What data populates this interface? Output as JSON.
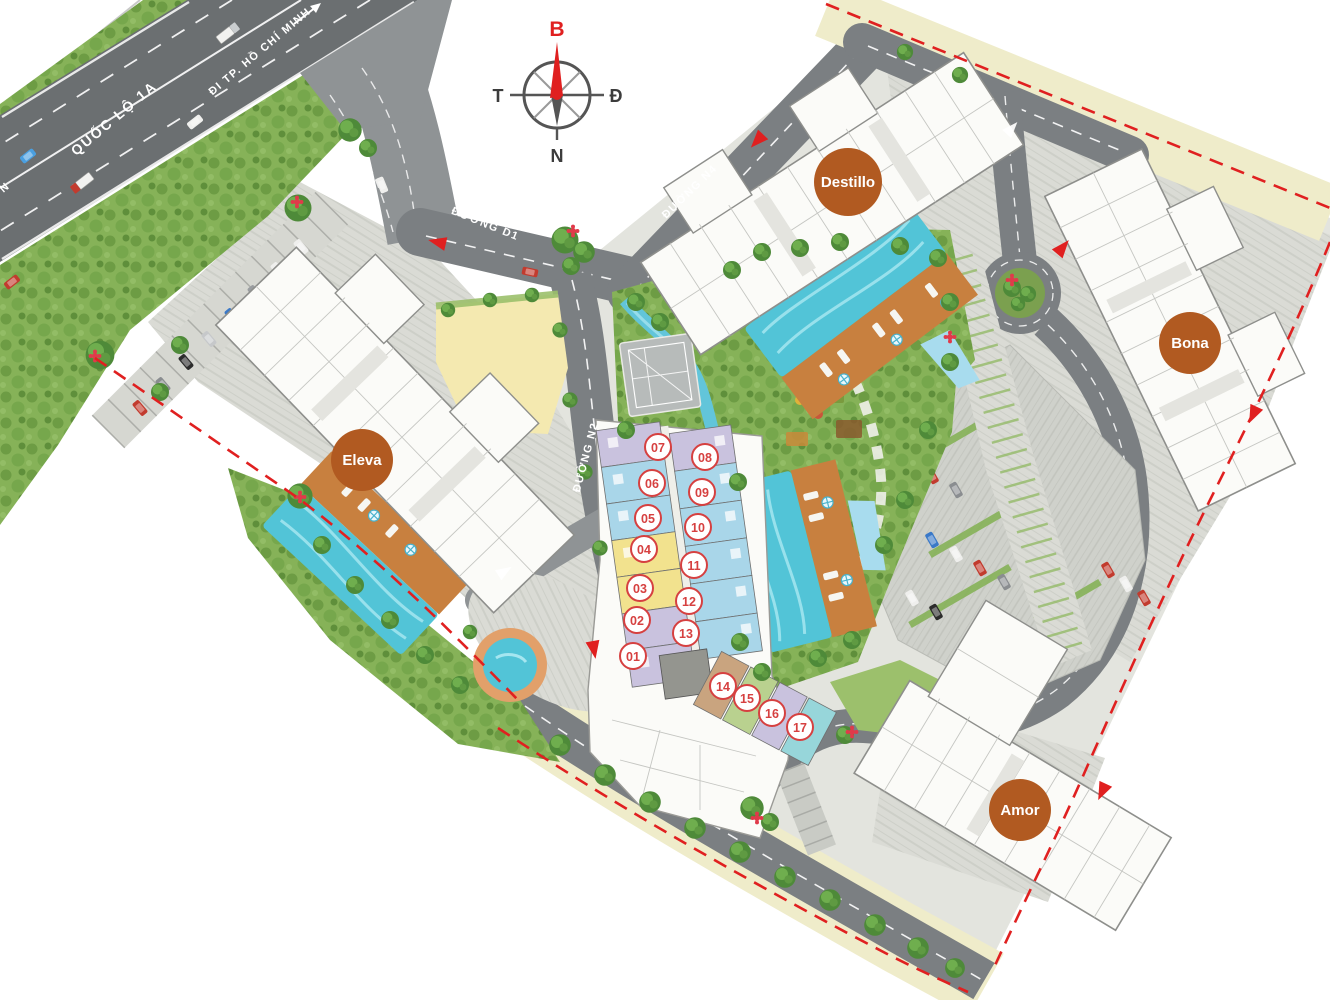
{
  "site_plan": {
    "compass": {
      "north_label": "B",
      "east_label": "Đ",
      "west_label": "T",
      "south_label": "N"
    },
    "road_labels": {
      "highway_name": "QUỐC LỘ 1A",
      "highway_direction": "ĐI TP. HỒ CHÍ MINH",
      "highway_direction_partial": "N",
      "road_d1": "ĐƯỜNG D1",
      "road_n4": "ĐƯỜNG N4",
      "road_n2": "ĐƯỜNG N2"
    },
    "towers": [
      {
        "id": "destillo",
        "name": "Destillo"
      },
      {
        "id": "bona",
        "name": "Bona"
      },
      {
        "id": "eleva",
        "name": "Eleva"
      },
      {
        "id": "amor",
        "name": "Amor"
      }
    ],
    "units": [
      {
        "label": "01"
      },
      {
        "label": "02"
      },
      {
        "label": "03"
      },
      {
        "label": "04"
      },
      {
        "label": "05"
      },
      {
        "label": "06"
      },
      {
        "label": "07"
      },
      {
        "label": "08"
      },
      {
        "label": "09"
      },
      {
        "label": "10"
      },
      {
        "label": "11"
      },
      {
        "label": "12"
      },
      {
        "label": "13"
      },
      {
        "label": "14"
      },
      {
        "label": "15"
      },
      {
        "label": "16"
      },
      {
        "label": "17"
      }
    ],
    "colors": {
      "tower_badge": "#b15a21",
      "unit_badge_border": "#d64040",
      "boundary_dash": "#e02020",
      "highway": "#6b6f71",
      "road": "#7b7f82",
      "pavement": "#dadbd5",
      "green": "#8ab25c",
      "water": "#52c4d7",
      "deck": "#c8803f",
      "cream_strip": "#efecca",
      "unit_lavender": "#c9c2de",
      "unit_blue": "#a9d6e9",
      "unit_yellow": "#f2e28e",
      "unit_brown": "#c9a47f",
      "unit_green": "#b9d18f",
      "unit_teal": "#97d6da"
    }
  }
}
